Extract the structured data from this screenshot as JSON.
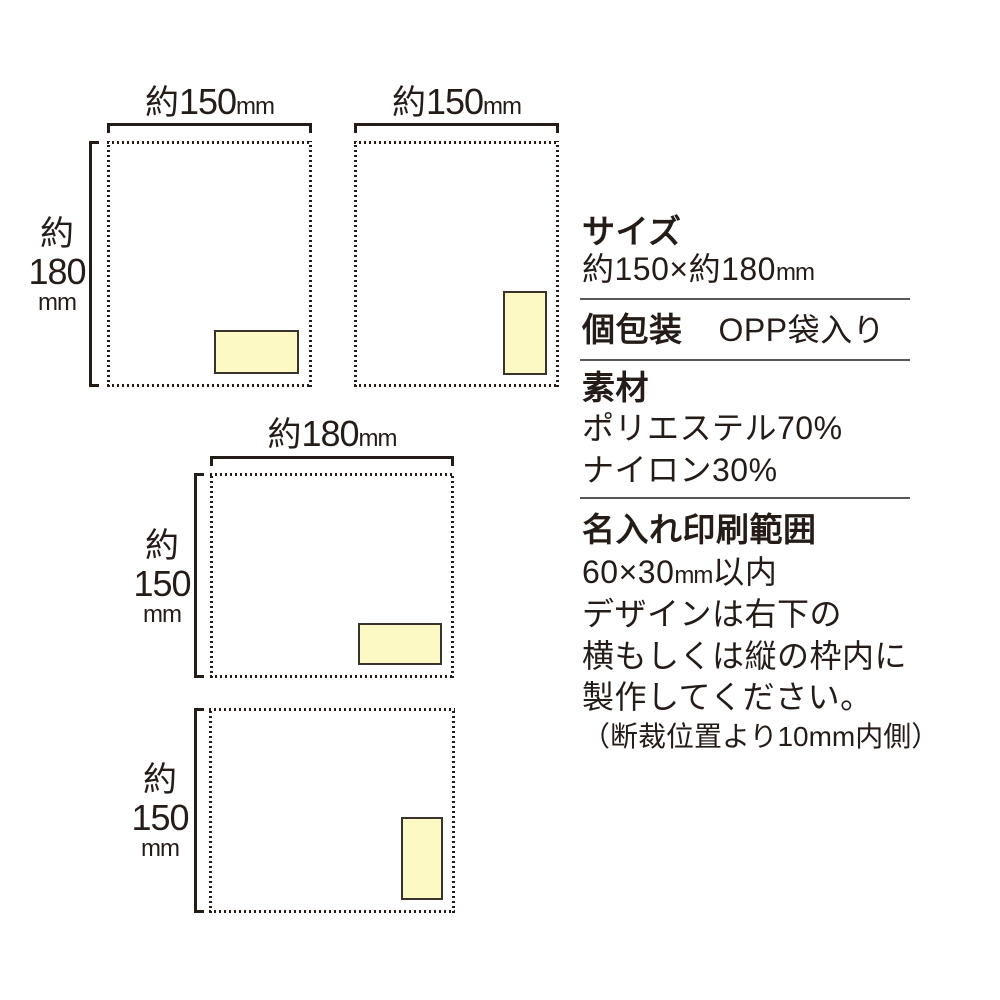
{
  "colors": {
    "ink": "#251c18",
    "separator": "#595757",
    "print_area_fill": "#fcf9c5",
    "print_area_border": "#3a322d",
    "background": "#ffffff"
  },
  "dims": {
    "d150": {
      "prefix": "約",
      "value": "150",
      "unit": "mm"
    },
    "d180": {
      "prefix": "約",
      "value": "180",
      "unit": "mm"
    }
  },
  "specs": {
    "size": {
      "heading": "サイズ",
      "value_main": "約150×約180",
      "value_unit": "mm"
    },
    "packaging": {
      "heading": "個包装",
      "value": "OPP袋入り"
    },
    "material": {
      "heading": "素材",
      "line1": "ポリエステル70%",
      "line2": "ナイロン30%"
    },
    "print_area": {
      "heading": "名入れ印刷範囲",
      "line1_main": "60×30",
      "line1_unit": "mm",
      "line1_suffix": "以内",
      "line2": "デザインは右下の",
      "line3": "横もしくは縦の枠内に",
      "line4": "製作してください。",
      "note_pre": "（断裁位置より10",
      "note_unit": "mm",
      "note_post": "内側）"
    }
  }
}
